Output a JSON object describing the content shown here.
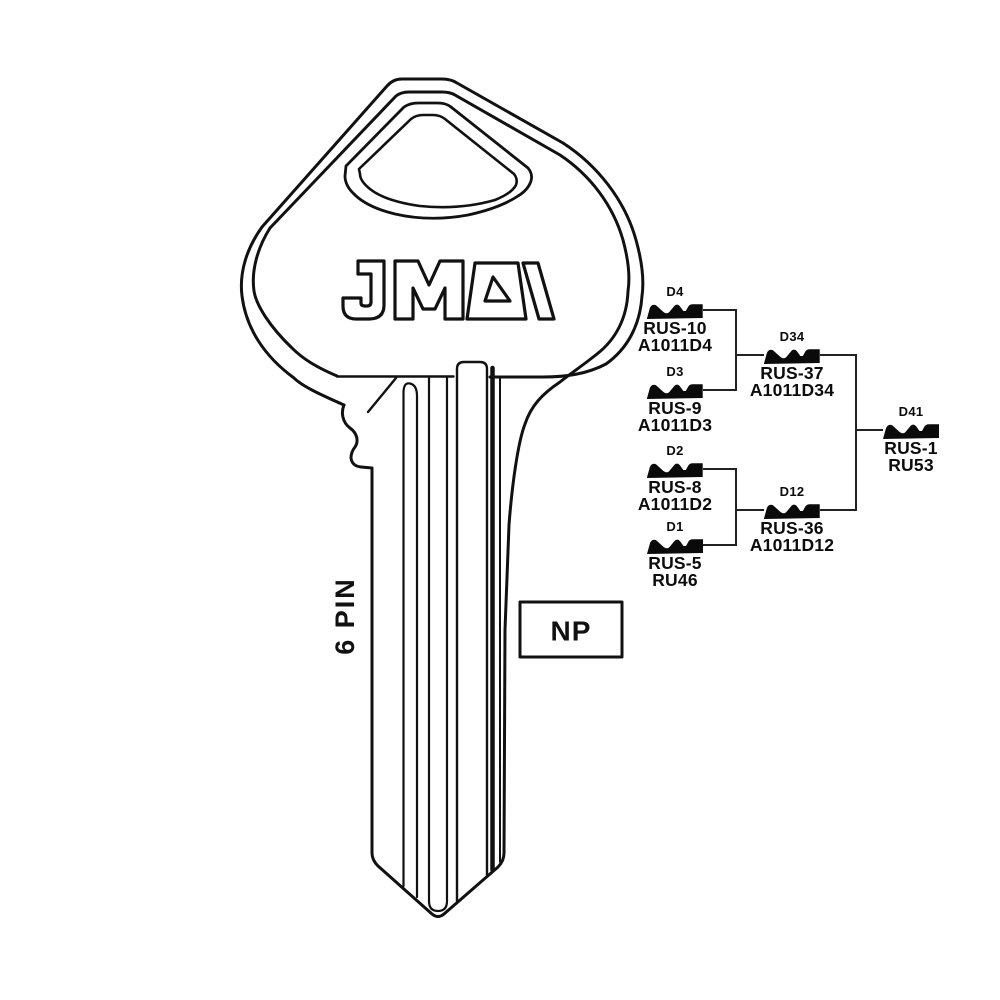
{
  "brand": {
    "logo_text": "JMA"
  },
  "key": {
    "pin_label": "6 PIN",
    "plating_code": "NP"
  },
  "tree": {
    "nodes": [
      {
        "profile": "D4",
        "name": "RUS-10",
        "alt": "A1011D4"
      },
      {
        "profile": "D3",
        "name": "RUS-9",
        "alt": "A1011D3"
      },
      {
        "profile": "D2",
        "name": "RUS-8",
        "alt": "A1011D2"
      },
      {
        "profile": "D1",
        "name": "RUS-5",
        "alt": "RU46"
      },
      {
        "profile": "D34",
        "name": "RUS-37",
        "alt": "A1011D34"
      },
      {
        "profile": "D12",
        "name": "RUS-36",
        "alt": "A1011D12"
      },
      {
        "profile": "D41",
        "name": "RUS-1",
        "alt": "RU53"
      }
    ]
  },
  "colors": {
    "ink": "#111111",
    "background": "#ffffff"
  }
}
